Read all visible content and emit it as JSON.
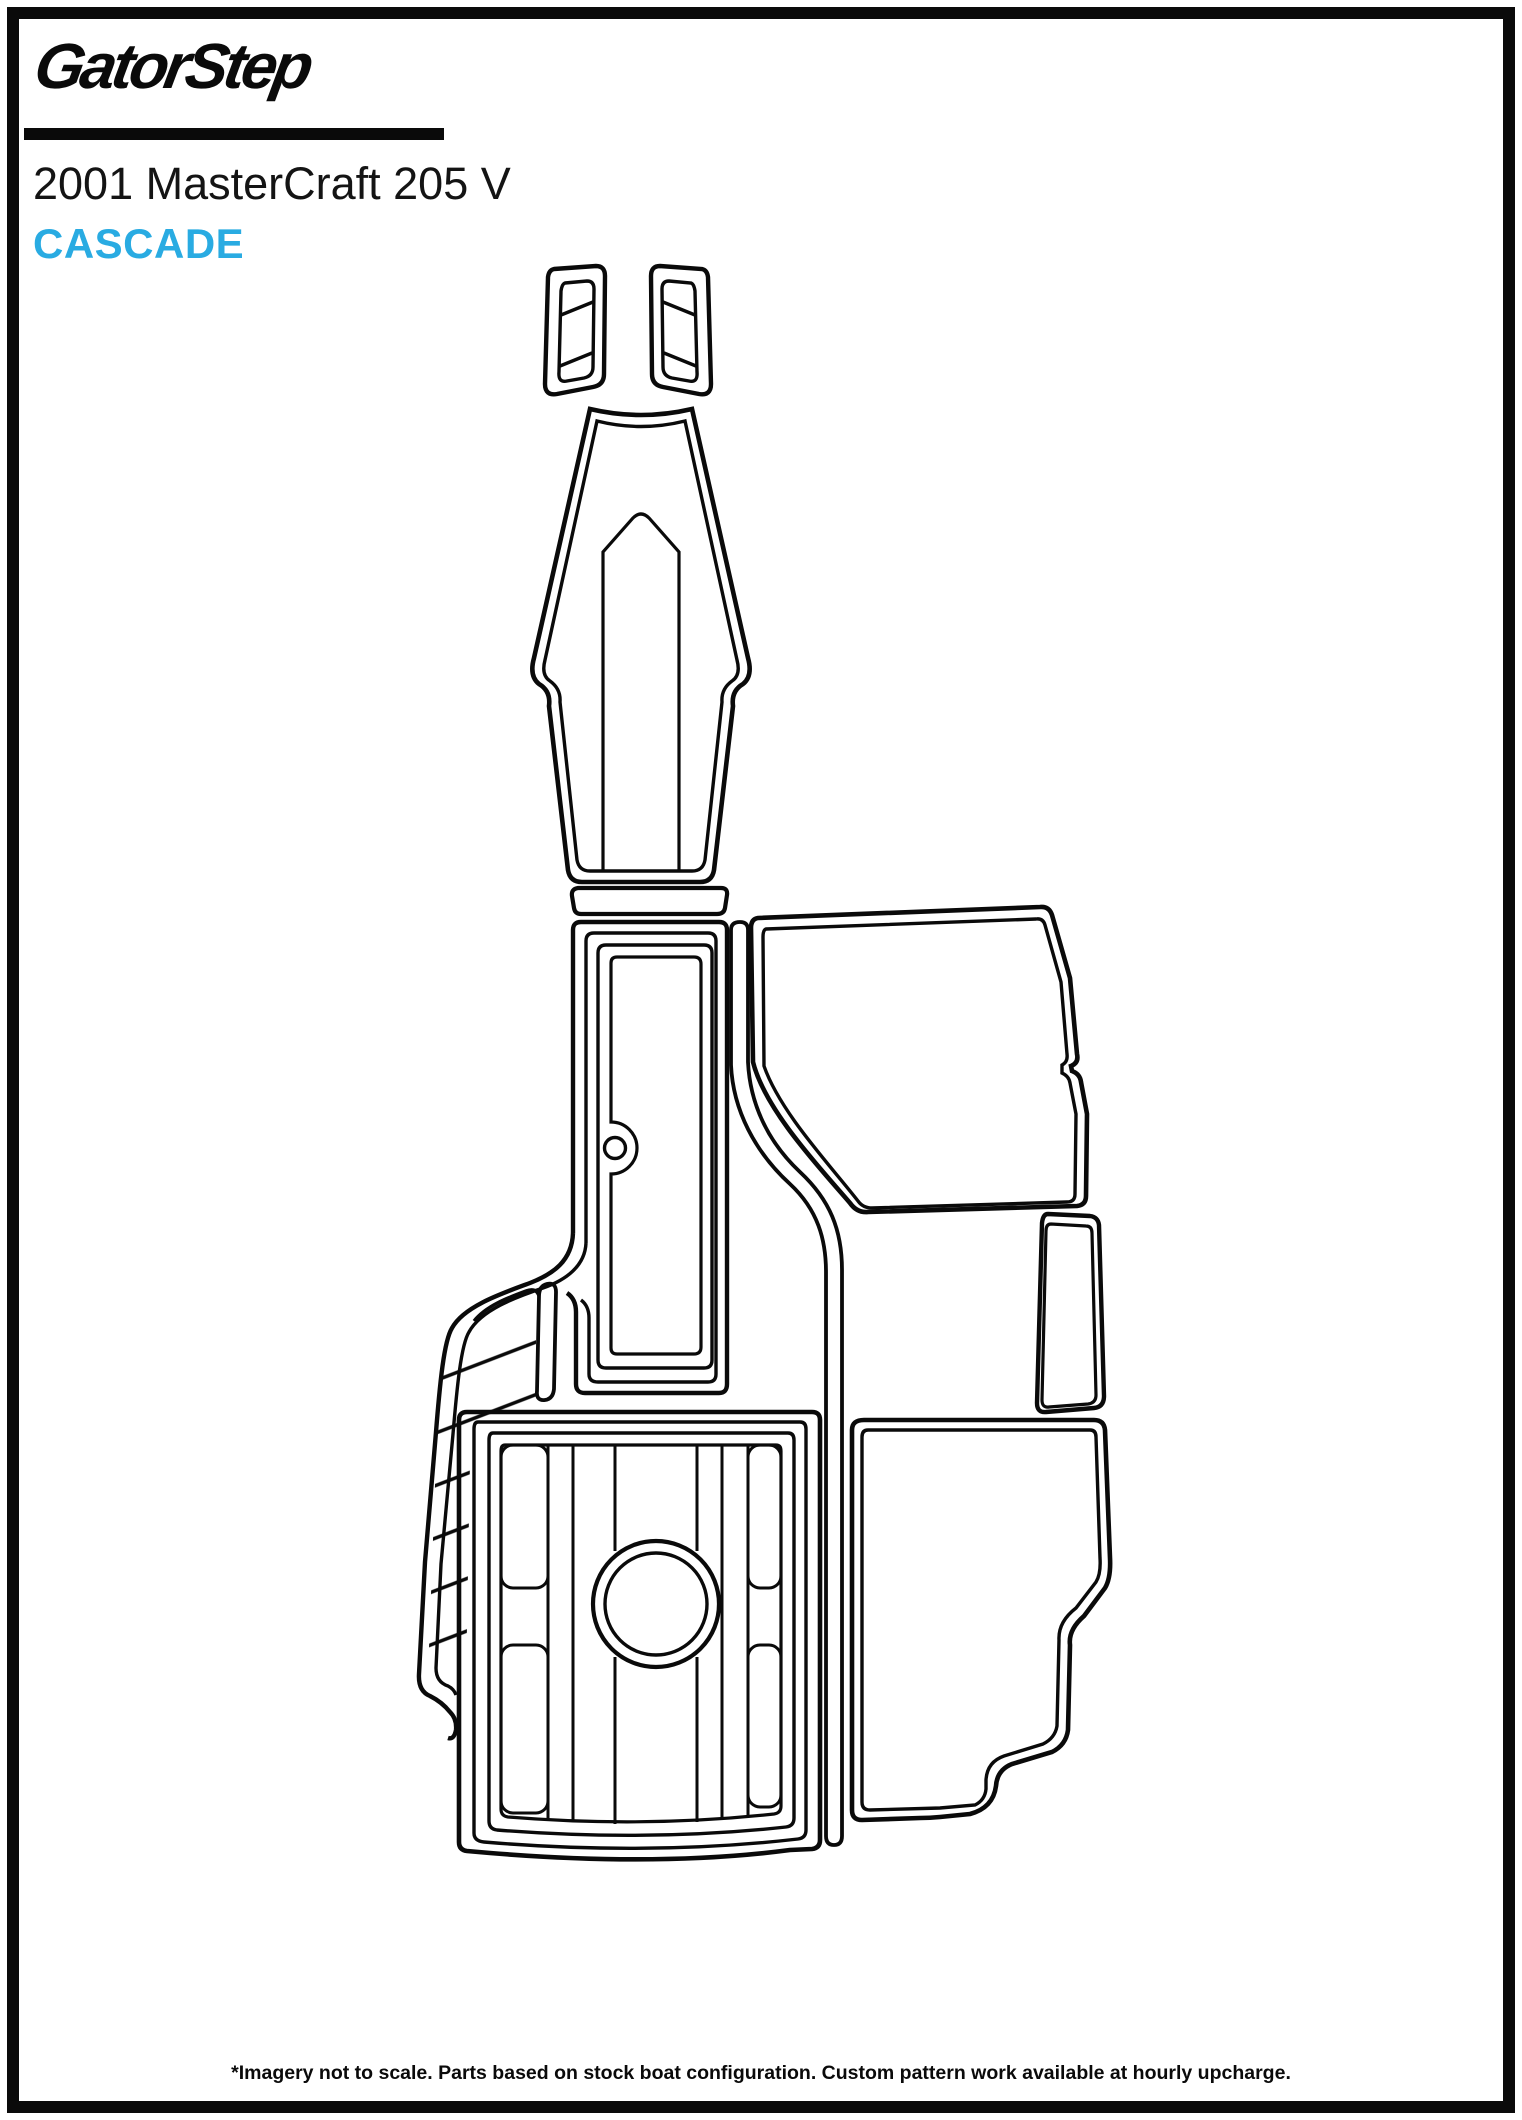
{
  "page": {
    "brand_logo": "GatorStep",
    "title": "2001 MasterCraft 205 V",
    "pattern_name": "CASCADE",
    "footer_note": "*Imagery not to scale. Parts based on stock boat configuration. Custom pattern work available at hourly upcharge.",
    "accent_color": "#29ABE2",
    "line_color": "#0a0a0a"
  },
  "diagram": {
    "description": "Top-down template outlines of GatorStep boat flooring pieces for a 2001 MasterCraft 205 V, drawn as black line art with diagonal traction hatching",
    "pieces": [
      {
        "name": "bow-step-pad-left",
        "hatched": true
      },
      {
        "name": "bow-step-pad-right",
        "hatched": true
      },
      {
        "name": "bow-walkway-pad",
        "hatched": false
      },
      {
        "name": "step-threshold-strip",
        "hatched": false
      },
      {
        "name": "center-aisle-pad",
        "hatched": false
      },
      {
        "name": "port-side-runner-pad",
        "hatched": true
      },
      {
        "name": "starboard-cockpit-pad",
        "hatched": true
      },
      {
        "name": "gunwale-filler-strip",
        "hatched": true
      },
      {
        "name": "side-step-pad",
        "hatched": true
      },
      {
        "name": "engine-hatch-pad",
        "hatched": true
      },
      {
        "name": "rear-bench-pad",
        "hatched": true
      }
    ]
  }
}
